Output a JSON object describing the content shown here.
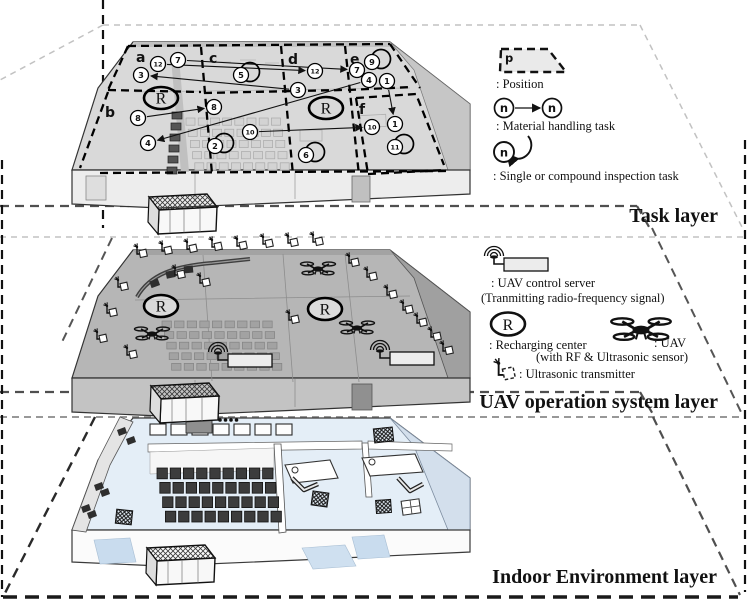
{
  "recharge_symbol": "R",
  "colors": {
    "task_building": "#d9d9d9",
    "uav_building": "#b6b6b6",
    "indoor_floor": "#e4eef7",
    "dashed_planes": "#bdbdbd",
    "ink": "#111111"
  },
  "layers": [
    {
      "id": "task",
      "label": "Task layer",
      "zones": [
        {
          "letter": "a",
          "x": 136,
          "y": 62
        },
        {
          "letter": "b",
          "x": 105,
          "y": 117
        },
        {
          "letter": "c",
          "x": 209,
          "y": 63
        },
        {
          "letter": "d",
          "x": 288,
          "y": 64
        },
        {
          "letter": "e",
          "x": 350,
          "y": 64
        },
        {
          "letter": "f",
          "x": 359,
          "y": 114
        }
      ],
      "recharging_centers": [
        {
          "x": 161,
          "y": 98
        },
        {
          "x": 326,
          "y": 108
        }
      ],
      "nodes": [
        {
          "n": "7",
          "x": 178,
          "y": 60
        },
        {
          "n": "12",
          "x": 158,
          "y": 64
        },
        {
          "n": "3",
          "x": 141,
          "y": 75
        },
        {
          "n": "5",
          "x": 241,
          "y": 75,
          "loop": true
        },
        {
          "n": "12",
          "x": 315,
          "y": 71
        },
        {
          "n": "7",
          "x": 357,
          "y": 70
        },
        {
          "n": "9",
          "x": 372,
          "y": 62,
          "loop": true
        },
        {
          "n": "3",
          "x": 298,
          "y": 90
        },
        {
          "n": "4",
          "x": 369,
          "y": 80
        },
        {
          "n": "1",
          "x": 387,
          "y": 81
        },
        {
          "n": "8",
          "x": 214,
          "y": 107
        },
        {
          "n": "8",
          "x": 138,
          "y": 118
        },
        {
          "n": "4",
          "x": 148,
          "y": 143
        },
        {
          "n": "2",
          "x": 215,
          "y": 146,
          "loop": true
        },
        {
          "n": "10",
          "x": 250,
          "y": 132
        },
        {
          "n": "10",
          "x": 372,
          "y": 127
        },
        {
          "n": "1",
          "x": 395,
          "y": 124
        },
        {
          "n": "6",
          "x": 306,
          "y": 155,
          "loop": true
        },
        {
          "n": "11",
          "x": 395,
          "y": 147,
          "loop": true
        }
      ],
      "arrows": [
        {
          "from": [
            158,
            64
          ],
          "to": [
            315,
            71
          ]
        },
        {
          "from": [
            178,
            60
          ],
          "to": [
            357,
            70
          ]
        },
        {
          "from": [
            298,
            90
          ],
          "to": [
            141,
            75
          ]
        },
        {
          "from": [
            138,
            118
          ],
          "to": [
            214,
            107
          ]
        },
        {
          "from": [
            369,
            80
          ],
          "to": [
            148,
            143
          ]
        },
        {
          "from": [
            250,
            132
          ],
          "to": [
            372,
            127
          ]
        },
        {
          "from": [
            387,
            81
          ],
          "to": [
            395,
            124
          ]
        }
      ]
    },
    {
      "id": "uav",
      "label": "UAV operation system layer",
      "recharging_centers": [
        {
          "x": 161,
          "y": 306
        },
        {
          "x": 325,
          "y": 309
        }
      ],
      "uavs": [
        [
          152,
          334
        ],
        [
          318,
          269
        ],
        [
          357,
          328
        ]
      ],
      "servers": [
        [
          218,
          352
        ],
        [
          380,
          350
        ]
      ],
      "transmitters": [
        [
          140,
          253
        ],
        [
          165,
          250
        ],
        [
          190,
          248
        ],
        [
          215,
          246
        ],
        [
          240,
          245
        ],
        [
          266,
          243
        ],
        [
          291,
          242
        ],
        [
          316,
          241
        ],
        [
          352,
          262
        ],
        [
          370,
          276
        ],
        [
          390,
          294
        ],
        [
          406,
          309
        ],
        [
          420,
          322
        ],
        [
          434,
          336
        ],
        [
          446,
          350
        ],
        [
          121,
          286
        ],
        [
          110,
          312
        ],
        [
          100,
          338
        ],
        [
          130,
          354
        ],
        [
          178,
          274
        ],
        [
          203,
          282
        ],
        [
          292,
          319
        ]
      ]
    },
    {
      "id": "indoor",
      "label": "Indoor Environment layer"
    }
  ],
  "task_legend": {
    "position_symbol": "p",
    "position_label": ": Position",
    "node_symbol": "n",
    "material_label": ": Material handling task",
    "inspection_label": ": Single or compound inspection task"
  },
  "uav_legend": {
    "server_label": ": UAV control server",
    "server_sublabel": "(Tranmitting radio-frequency signal)",
    "recharge_label": ": Recharging center",
    "uav_label": ": UAV",
    "uav_sublabel": "(with RF & Ultrasonic sensor)",
    "ultrasonic_label": ": Ultrasonic transmitter"
  }
}
